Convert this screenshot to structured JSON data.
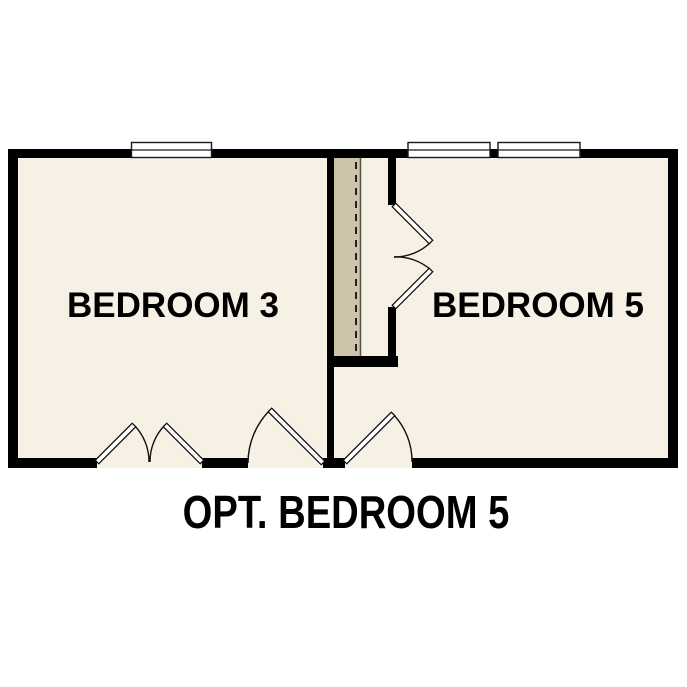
{
  "floor_plan": {
    "rooms": [
      {
        "label": "BEDROOM 3"
      },
      {
        "label": "BEDROOM 5"
      }
    ],
    "caption": "OPT. BEDROOM 5"
  },
  "colors": {
    "background": "#ffffff",
    "floor": "#f7f0e4",
    "closet_floor": "#cdc3a8",
    "wall": "#000000",
    "window_fill": "#ffffff",
    "door_fill": "#ffffff",
    "text": "#000000"
  }
}
